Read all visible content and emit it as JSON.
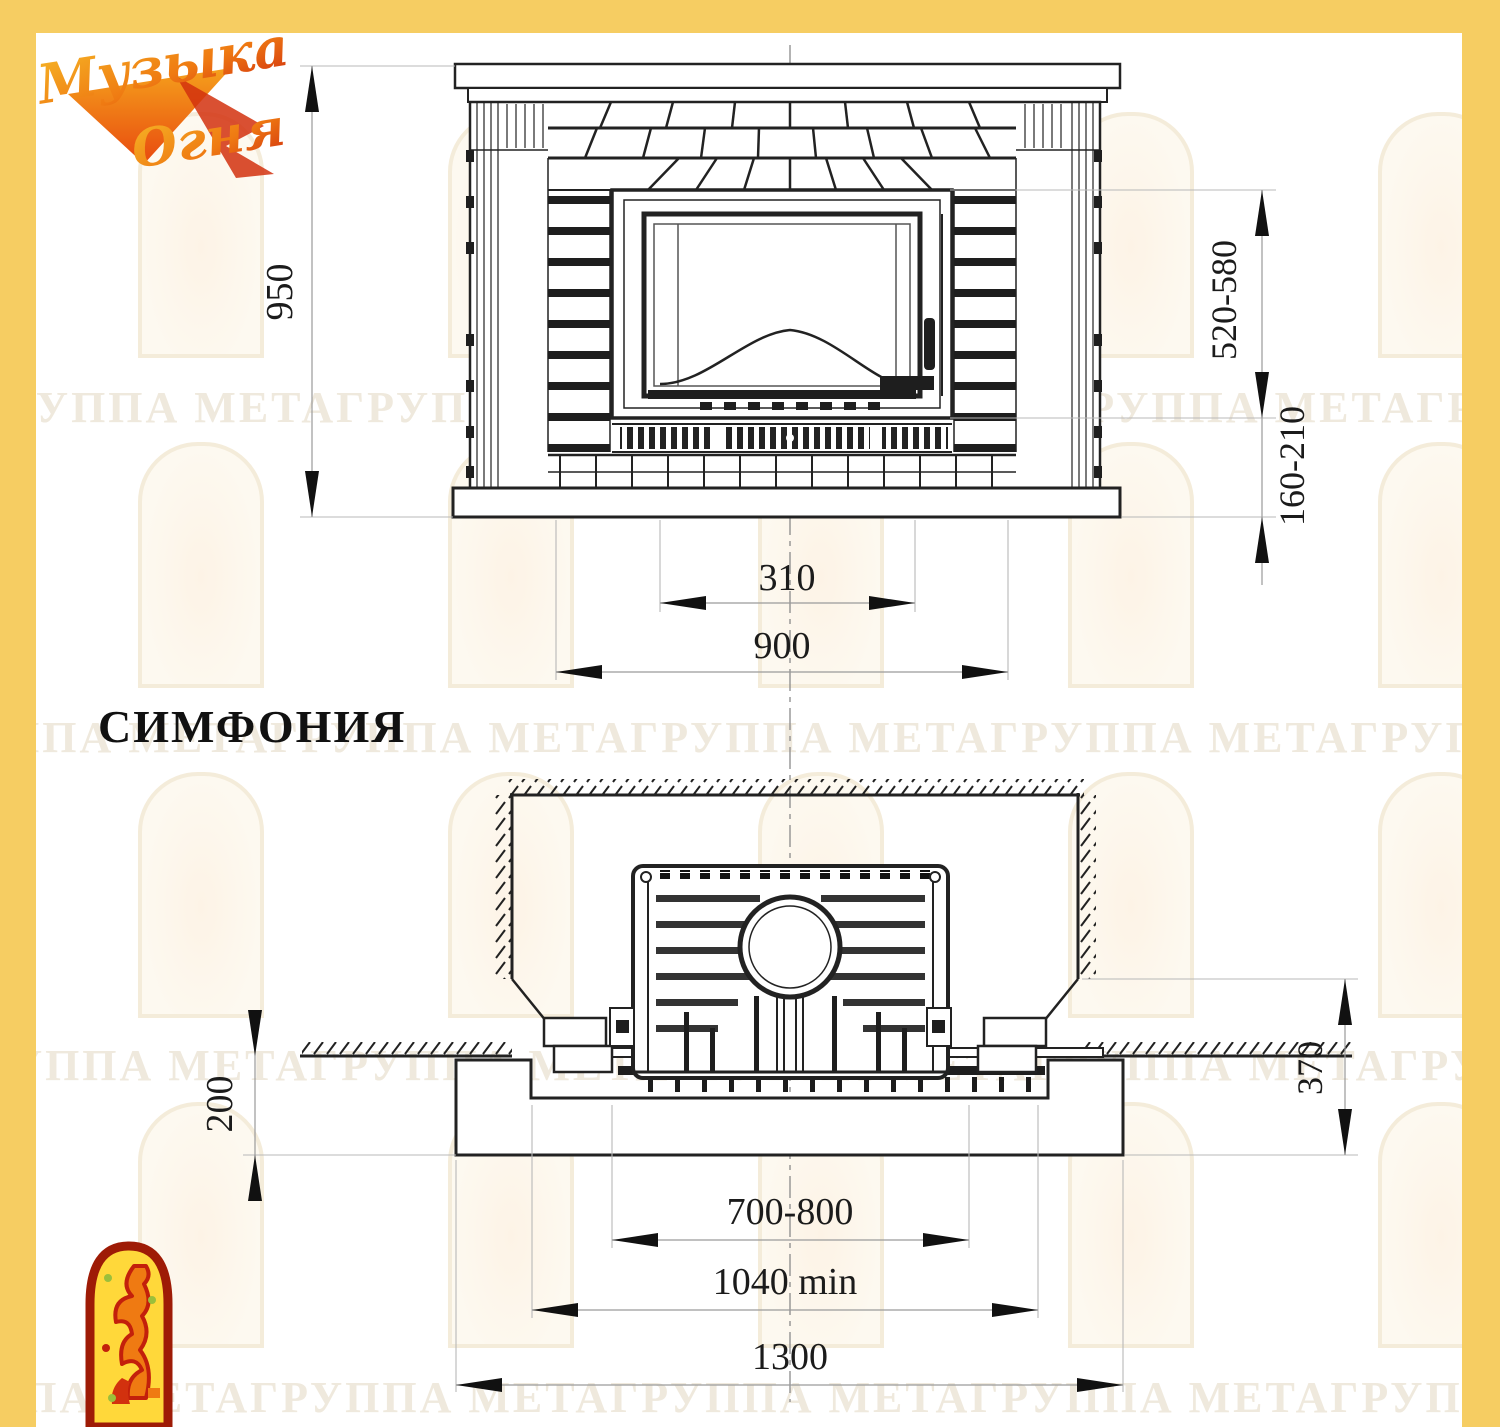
{
  "page": {
    "product_name": "СИМФОНИЯ"
  },
  "logo": {
    "word1": "Музыка",
    "word2": "Огня"
  },
  "front_view": {
    "dims": {
      "overall_height": "950",
      "firebox_height_range": "520-580",
      "hearth_height_range": "160-210",
      "ash_width": "310",
      "inner_width": "900"
    }
  },
  "plan_view": {
    "dims": {
      "foundation_depth": "200",
      "side_clearance": "370",
      "firebox_width_range": "700-800",
      "niche_width_min": "1040 min",
      "foundation_width": "1300"
    }
  },
  "watermark": {
    "row_text": "ГРУППА МЕТАГРУППА МЕТАГРУППА МЕТАГРУППА МЕТАГРУППА МЕТАГРУППА МЕТА"
  },
  "colors": {
    "frame_yellow": "#F6CD62",
    "logo_orange": "#F59B1E",
    "logo_red": "#D2310E",
    "mascot_yellow": "#FFD83A",
    "mascot_border": "#9E1B06",
    "drawing_line": "#222222"
  }
}
